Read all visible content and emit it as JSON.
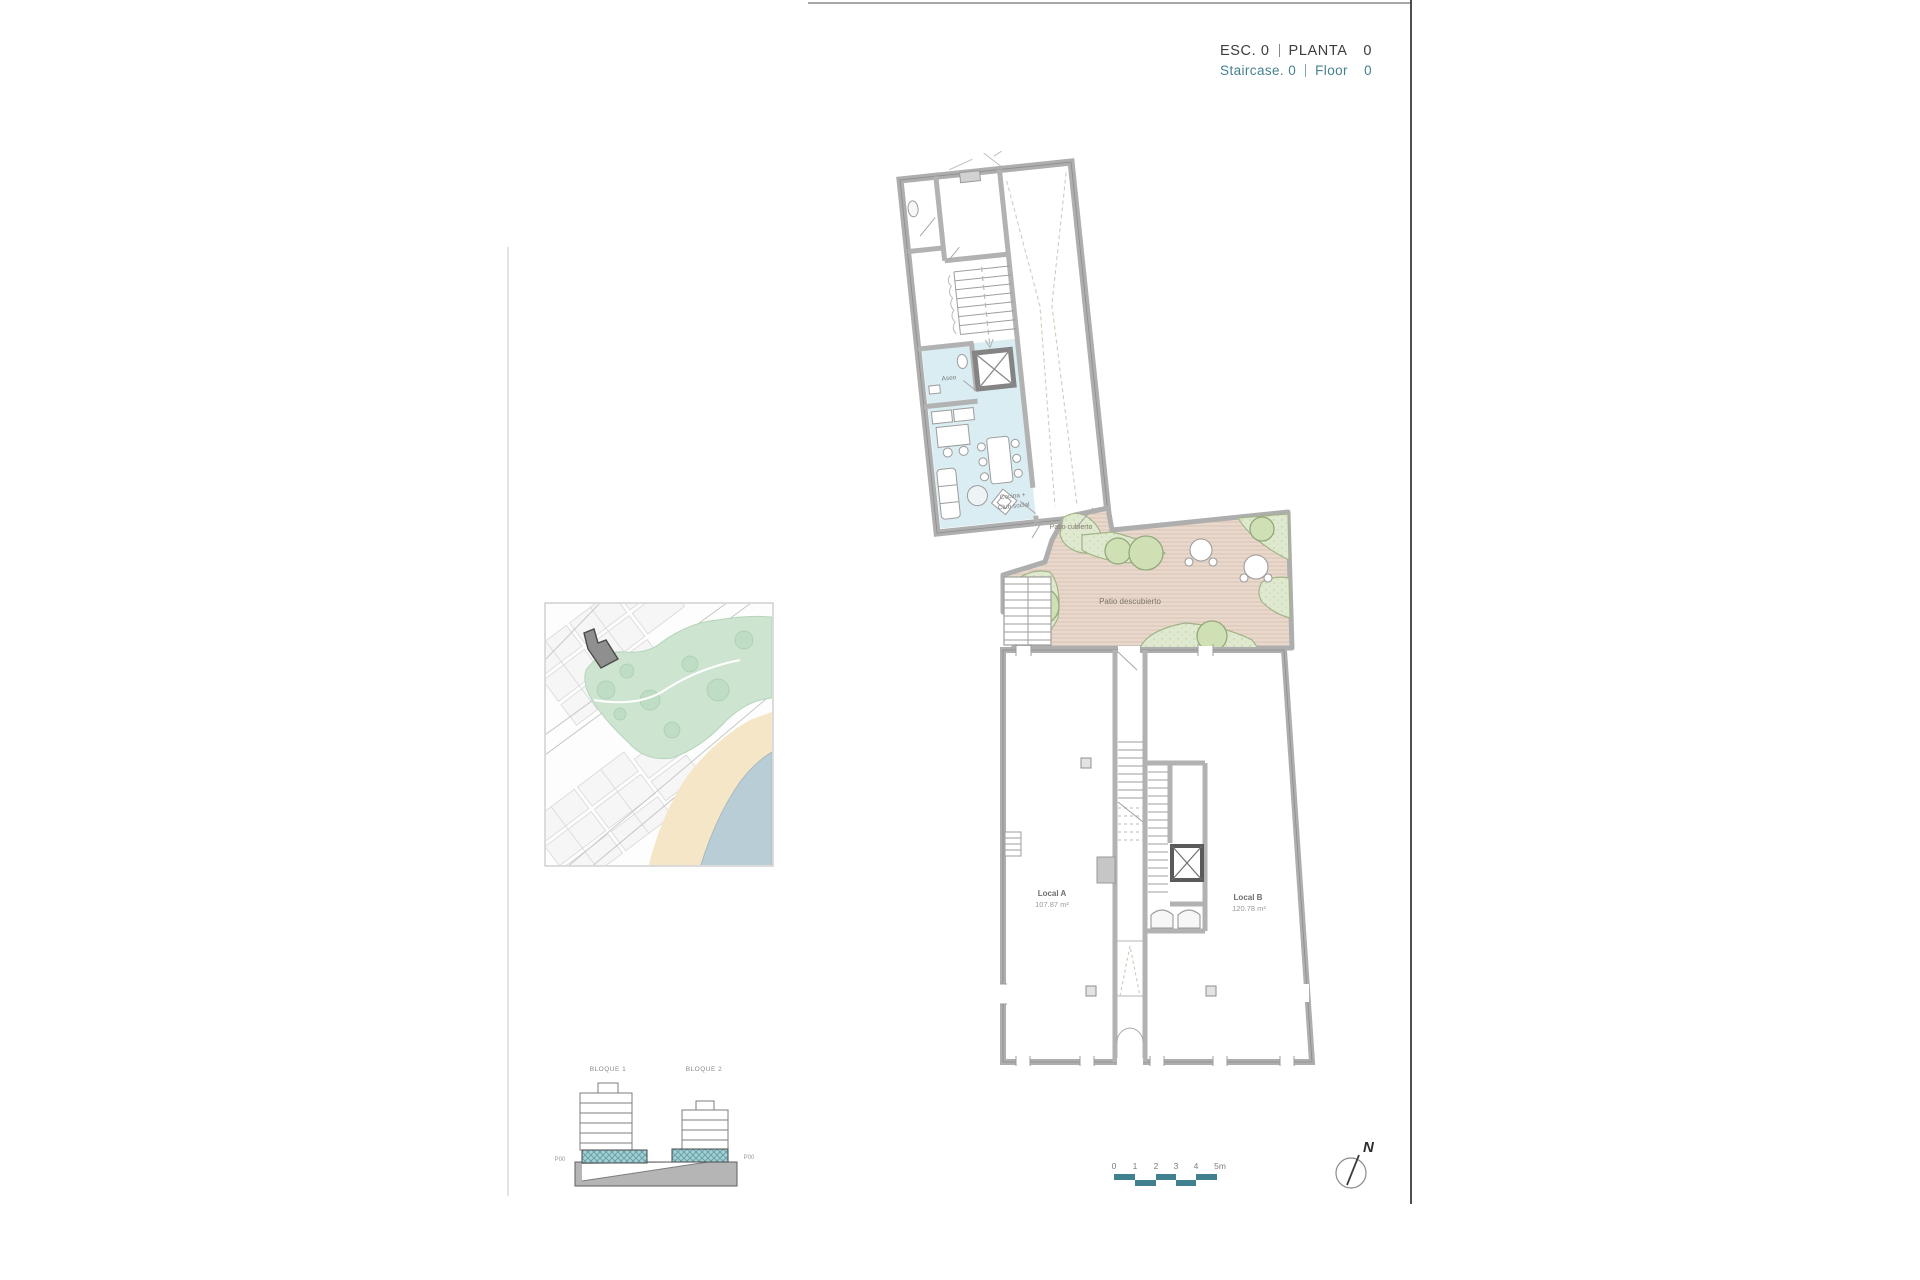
{
  "header": {
    "esc_label": "ESC.",
    "esc_value": "0",
    "planta_label": "PLANTA",
    "planta_value": "0",
    "staircase_label": "Staircase.",
    "staircase_value": "0",
    "floor_label": "Floor",
    "floor_value": "0"
  },
  "plan": {
    "upper": {
      "aseo": "Aseo",
      "cocina_line1": "Cocina +",
      "cocina_line2": "Club social"
    },
    "patio": {
      "covered": "Patio cubierto",
      "open": "Patio descubierto"
    },
    "lower": {
      "local_a": "Local A",
      "local_a_area": "107.87 m²",
      "local_b": "Local B",
      "local_b_area": "120.78 m²"
    }
  },
  "elevation": {
    "block1": "BLOQUE 1",
    "block2": "BLOQUE 2",
    "level_left": "P00",
    "level_right": "P00"
  },
  "scalebar": {
    "ticks": [
      "0",
      "1",
      "2",
      "3",
      "4",
      "5m"
    ]
  },
  "compass": {
    "north": "N"
  },
  "colors": {
    "accent_teal": "#45828e",
    "scalebar_teal": "#41808f",
    "floor_highlight": "#8cc5c9",
    "wall_gray": "#b0b0b0",
    "room_blue": "#d9edf2",
    "patio_tan": "#e9d8cc",
    "green": "#dfe9cf"
  }
}
